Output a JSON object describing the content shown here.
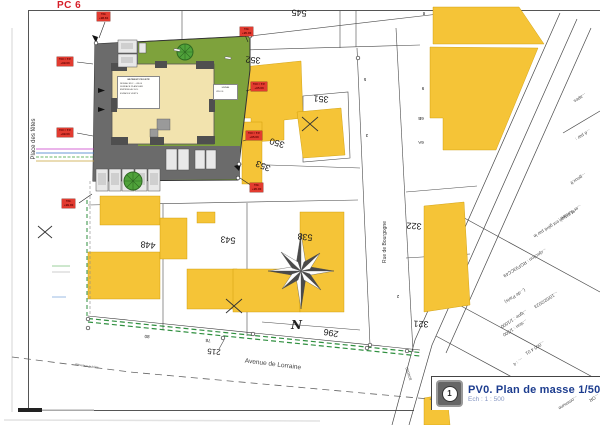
{
  "header": {
    "doc_code": "PC 6"
  },
  "streets": {
    "place_des_fetes": "Place des fêtes",
    "rue_de_bourgogne": "Rue de Bourgogne",
    "avenue_de_lorraine": "Avenue de Lorraine"
  },
  "compass": {
    "north_letter": "N"
  },
  "road_ref": "824080",
  "utility_label": "Réseaux publics",
  "parcels": [
    "545",
    "352",
    "351",
    "350",
    "353",
    "322",
    "321",
    "296",
    "538",
    "543",
    "448",
    "215"
  ],
  "small_numbers": [
    "8",
    "5",
    "3",
    "9",
    "6B",
    "6A",
    "2",
    "80",
    "78"
  ],
  "elevation_labels": [
    {
      "name": "T.N.",
      "value": "+98.81"
    },
    {
      "name": "T.N = T.F",
      "value": "+99.00"
    },
    {
      "name": "T.N = T.F",
      "value": "+99.00"
    },
    {
      "name": "T.N.",
      "value": "+99.00"
    },
    {
      "name": "T.N.",
      "value": "+95.00"
    },
    {
      "name": "T.N = T.F",
      "value": "+95.00"
    },
    {
      "name": "T.N = T.F",
      "value": "+95.00"
    },
    {
      "name": "T.N.",
      "value": "+95.00"
    }
  ],
  "building_box": {
    "lines": [
      "BÂTIMENT PROJETÉ",
      "NIVEAU RDC : +99.00",
      "SURFACE PLANCHER",
      "EMPRISE AU SOL",
      "ESPACES VERTS"
    ]
  },
  "annex_box": {
    "lines": [
      "LOCAL",
      "VÉLOS"
    ]
  },
  "footer_fragments": [
    "...apes",
    "...é par :",
    "...gouv.fr",
    "...er suivant :",
    "...et extrait est géré par le",
    "...ojection : RGF93CC49",
    "(...de Paris)",
    "...10/02/2023",
    "...igne : 1/1000",
    "...sion : 1/500",
    "...000 4 01",
    "... : 4",
    "...ommune",
    "...OR"
  ],
  "title_block": {
    "index": "1",
    "title": "PV0. Plan de masse 1/500",
    "scale": "Ech : 1 : 500"
  },
  "colors": {
    "building_yellow": "#F5C437",
    "site_green": "#7EA23C",
    "site_gray": "#6B6B6B",
    "building_cream": "#F2E3AE",
    "elevation_red": "#E23B30",
    "title_navy": "#1D3D8F",
    "doc_red": "#D61E28"
  }
}
